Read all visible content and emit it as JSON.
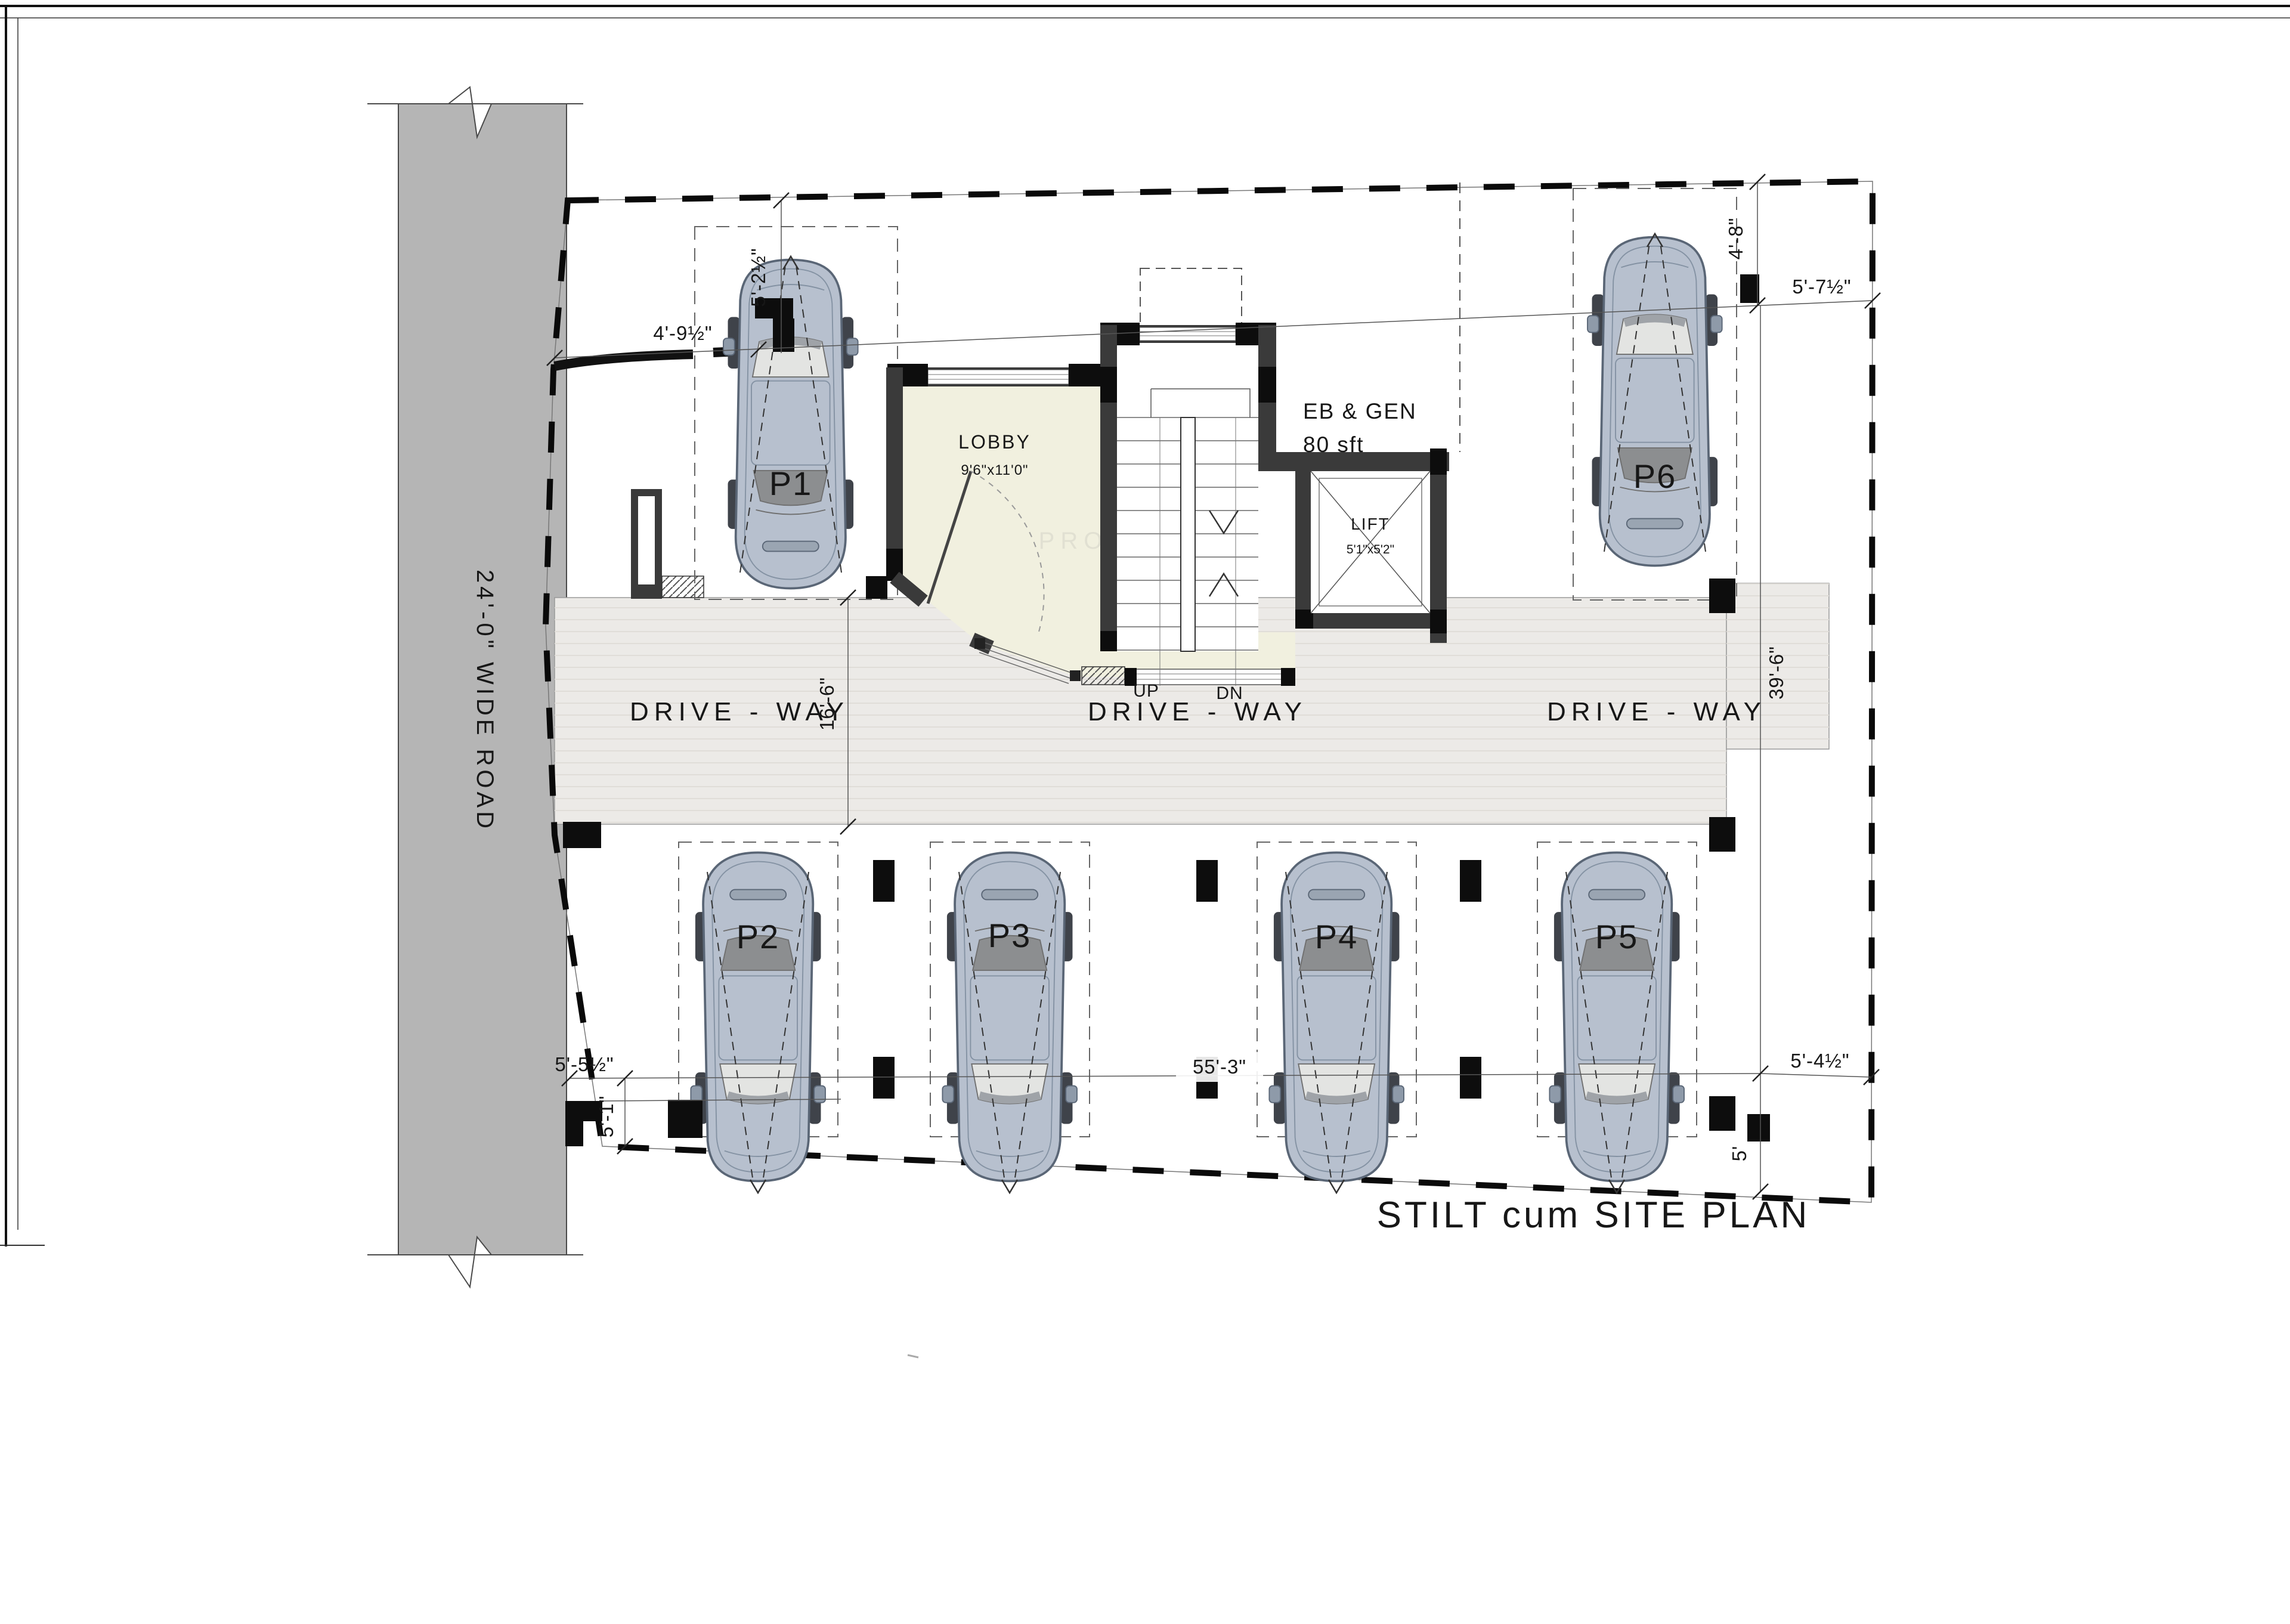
{
  "sheet": {
    "title": "STILT cum SITE PLAN",
    "watermark": "PRO"
  },
  "road": {
    "label": "24'-0\" WIDE ROAD"
  },
  "driveway": {
    "label_left": "DRIVE - WAY",
    "label_center": "DRIVE - WAY",
    "label_right": "DRIVE - WAY"
  },
  "lobby": {
    "name": "LOBBY",
    "size": "9'6\"x11'0\""
  },
  "stairs": {
    "up": "UP",
    "down": "DN"
  },
  "lift": {
    "name": "LIFT",
    "size": "5'1\"x5'2\""
  },
  "ebgen": {
    "name": "EB & GEN",
    "area": "80 sft"
  },
  "parking": {
    "p1": "P1",
    "p2": "P2",
    "p3": "P3",
    "p4": "P4",
    "p5": "P5",
    "p6": "P6"
  },
  "dimensions": {
    "top_left_vertical": "5'-2½\"",
    "top_left_horizontal": "4'-9½\"",
    "top_right_vertical": "4'-8\"",
    "top_right_horizontal": "5'-7½\"",
    "driveway_width": "16'-6\"",
    "plot_depth_right": "39'-6\"",
    "bottom_left_horizontal": "5'-5½\"",
    "bottom_left_vertical": "5'-1\"",
    "bottom_width": "55'-3\"",
    "bottom_right_horizontal": "5'-4½\"",
    "bottom_right_vertical": "5'"
  },
  "colors": {
    "road": "#b5b5b5",
    "driveway": "#eceae7",
    "lobby_floor": "#f1f0df",
    "wall": "#3a3a3a",
    "column": "#0d0d0d",
    "car_body": "#b7c0ce",
    "boundary": "#0a0a0a"
  }
}
